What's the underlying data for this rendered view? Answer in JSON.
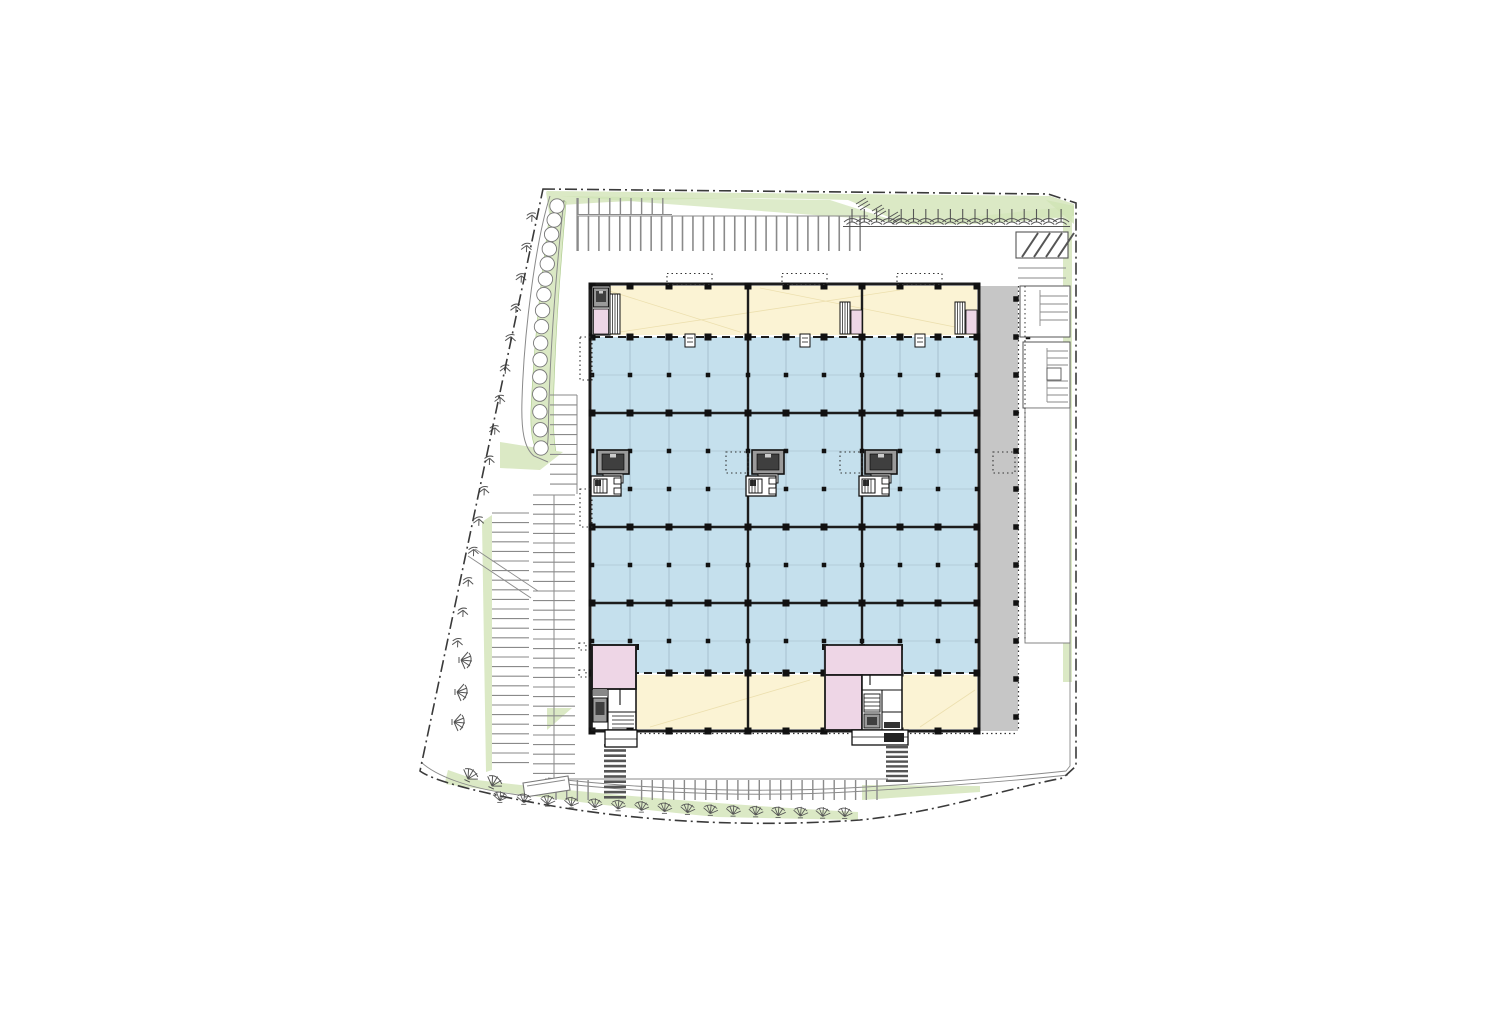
{
  "document": {
    "kind": "architectural-site-plan",
    "level": "ground-floor",
    "visible_text": []
  },
  "palette": {
    "paper": "#ffffff",
    "site_outline": "#3a3a3a",
    "road_line": "#8a8a8a",
    "greenery": "#dbe9c5",
    "greenery_wedge": "#cfe3b4",
    "greenery_edge": "#aac989",
    "office_fill": "#fbf3d4",
    "office_hatch": "#ecdfae",
    "warehouse_fill": "#c5e0ed",
    "warehouse_grid": "#9fb9c6",
    "core_fill": "#eed6e6",
    "dock_fill": "#c6c6c6",
    "building_wall": "#1c1c1c",
    "column": "#111111",
    "elev_frame": "#9a9a9a",
    "elev_cab": "#3f3f3f",
    "stair_dark": "#333333",
    "white": "#ffffff"
  },
  "site": {
    "boundary_style": "dash-dot",
    "shape": "irregular-pentagon"
  },
  "parking": {
    "north_row_upper_stalls": 9,
    "north_row_lower_stalls": 28,
    "west_upper_column_stalls": 10,
    "west_left_column_stalls": 27,
    "west_right_column_stalls": 30,
    "south_row_stalls": 31,
    "ramp_hatch_lines": 4,
    "crosswalk_west_rungs": 11,
    "crosswalk_center_rungs": 8
  },
  "trees": {
    "top_row": 18,
    "west_boundary": 15,
    "west_fans": 3,
    "corner_fans": 2,
    "south_band": 16,
    "west_island_bushes": 16,
    "wedge_marks": 3
  },
  "building": {
    "bays": 3,
    "blue_cores": 3,
    "grid": {
      "columns_x": [
        592,
        630,
        669,
        708,
        748,
        786,
        824,
        862,
        900,
        938,
        977
      ],
      "heavy_rows_y": [
        337,
        413,
        527,
        603,
        673
      ],
      "wall_rows_y": [
        286,
        731
      ],
      "interior_rows_y": [
        375,
        451,
        489,
        565,
        641
      ],
      "dock_rows_y": [
        299,
        337,
        375,
        413,
        451,
        489,
        527,
        565,
        603,
        641,
        679,
        717
      ]
    },
    "core_elevators_x": [
      597,
      752,
      865
    ],
    "core_stairs_x": [
      591,
      746,
      859
    ],
    "shaft_dotted_x": [
      726,
      840,
      993
    ],
    "canopy_dashed_x": [
      667,
      782,
      897
    ],
    "door_marks_x": [
      690,
      805,
      920
    ],
    "top_strip_minicores_x": [
      862,
      977
    ],
    "zones": [
      {
        "name": "office-strip-north",
        "color_key": "office_fill"
      },
      {
        "name": "warehouse-hall",
        "color_key": "warehouse_fill"
      },
      {
        "name": "office-strip-south",
        "color_key": "office_fill"
      },
      {
        "name": "loading-dock",
        "color_key": "dock_fill"
      },
      {
        "name": "stair-core",
        "color_key": "core_fill"
      }
    ]
  }
}
